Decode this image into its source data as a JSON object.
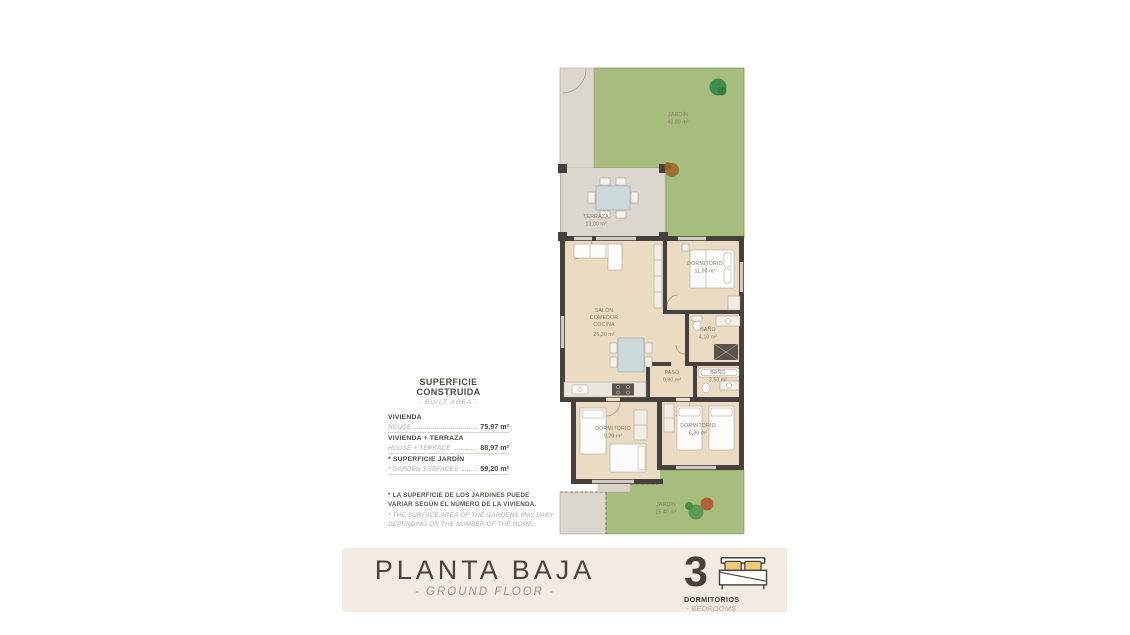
{
  "floorplan": {
    "rooms": {
      "jardin_top": {
        "name": "JARDÍN",
        "area": "43,80 m²"
      },
      "terraza": {
        "name": "TERRAZA",
        "area": "13,00 m²"
      },
      "salon": {
        "name1": "SALÓN",
        "name2": "COMEDOR",
        "name3": "COCINA",
        "area": "26,30 m²"
      },
      "dormitorio_1": {
        "name": "DORMITORIO",
        "area": "11,90 m²"
      },
      "bano_1": {
        "name": "BAÑO",
        "area": "4,10 m²"
      },
      "paso": {
        "name": "PASO",
        "area": "0,90 m²"
      },
      "bano_2": {
        "name": "BAÑO",
        "area": "3,50 m²"
      },
      "dormitorio_2": {
        "name": "DORMITORIO",
        "area": "9,20 m²"
      },
      "dormitorio_3": {
        "name": "DORMITORIO",
        "area": "8,80 m²"
      },
      "jardin_bottom": {
        "name": "JARDÍN",
        "area": "15,40 m²"
      }
    }
  },
  "area_panel": {
    "title": "SUPERFICIE CONSTRUIDA",
    "subtitle": "- BUILT AREA -",
    "rows": [
      {
        "label_es": "VIVIENDA",
        "label_en": "HOUSE",
        "value": "75,97 m²"
      },
      {
        "label_es": "VIVIENDA + TERRAZA",
        "label_en": "HOUSE + TERRACE",
        "value": "88,97 m²"
      },
      {
        "label_es": "* SUPERFICIE JARDÍN",
        "label_en": "* GARDEN SURFACES",
        "value": "59,20 m²"
      }
    ]
  },
  "footnote": {
    "es": "* LA SUPERFICIE DE LOS JARDINES PUEDE VARIAR SEGÚN EL NÚMERO DE LA VIVIENDA.",
    "en": "* THE SURFACE AREA OF THE GARDENS MAY VARY DEPENDING ON THE NUMBER OF THE HOME."
  },
  "footer": {
    "title": "PLANTA BAJA",
    "subtitle": "- GROUND FLOOR -",
    "bedrooms_count": "3",
    "bedrooms_label_es": "DORMITORIOS",
    "bedrooms_separator": " - ",
    "bedrooms_label_en": "BEDROOMS"
  },
  "icons": {
    "bed_icon": "double-bed-with-two-pillows"
  },
  "colors": {
    "garden_green": "#a7bd7d",
    "floor_beige": "#ebdbc3",
    "terrace_grey": "#dbd6ce",
    "wall_dark": "#46413d",
    "footer_bg": "#f2ebe2",
    "pillow_yellow": "#f0ca79",
    "label_brown": "#8b7a66",
    "text_dark": "#49443e",
    "text_muted": "#b3aba0"
  }
}
